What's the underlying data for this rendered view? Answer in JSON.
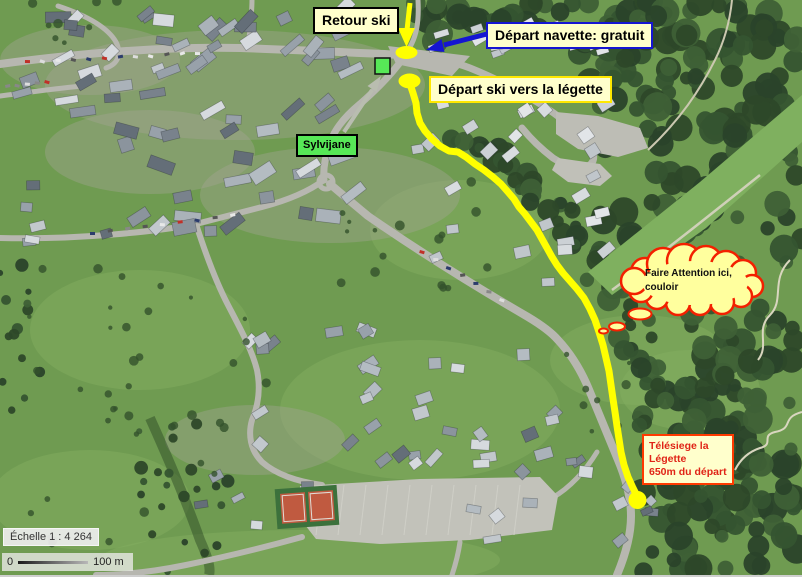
{
  "annotations": {
    "retour_ski": "Retour ski",
    "depart_navette": "Départ navette: gratuit",
    "depart_ski": "Départ ski vers la légette",
    "sylvijane": "Sylvijane",
    "warning": {
      "line1": "Faire Attention ici,",
      "line2": "couloir"
    },
    "telesiege": {
      "line1": "Télésiege la",
      "line2": "Légette",
      "line3": "650m du départ"
    }
  },
  "scale": {
    "label": "Échelle 1 : 4 264",
    "bar_start": "0",
    "bar_end": "100 m"
  },
  "route": {
    "color": "#ffff00",
    "points": [
      [
        409,
        81
      ],
      [
        413,
        93
      ],
      [
        416,
        103
      ],
      [
        417,
        113
      ],
      [
        420,
        123
      ],
      [
        425,
        131
      ],
      [
        432,
        139
      ],
      [
        440,
        146
      ],
      [
        449,
        151
      ],
      [
        458,
        152
      ],
      [
        466,
        157
      ],
      [
        475,
        164
      ],
      [
        484,
        170
      ],
      [
        493,
        177
      ],
      [
        501,
        184
      ],
      [
        508,
        192
      ],
      [
        514,
        199
      ],
      [
        519,
        207
      ],
      [
        525,
        214
      ],
      [
        531,
        222
      ],
      [
        537,
        230
      ],
      [
        542,
        239
      ],
      [
        547,
        248
      ],
      [
        552,
        257
      ],
      [
        557,
        265
      ],
      [
        563,
        273
      ],
      [
        570,
        281
      ],
      [
        577,
        289
      ],
      [
        584,
        298
      ],
      [
        590,
        309
      ],
      [
        595,
        320
      ],
      [
        599,
        332
      ],
      [
        603,
        345
      ],
      [
        606,
        358
      ],
      [
        609,
        371
      ],
      [
        611,
        385
      ],
      [
        613,
        399
      ],
      [
        615,
        412
      ],
      [
        617,
        426
      ],
      [
        619,
        439
      ],
      [
        621,
        452
      ],
      [
        624,
        465
      ],
      [
        628,
        477
      ],
      [
        633,
        488
      ],
      [
        637,
        496
      ]
    ]
  },
  "colors": {
    "label_bg": "#ffffcc",
    "annotation_yellow": "#ffff00",
    "navette_blue": "#1515d2",
    "sylvijane_green": "#57e857",
    "warning_fill": "#ffff9e",
    "warning_border": "#f32000",
    "telesiege_red": "#e02417"
  }
}
